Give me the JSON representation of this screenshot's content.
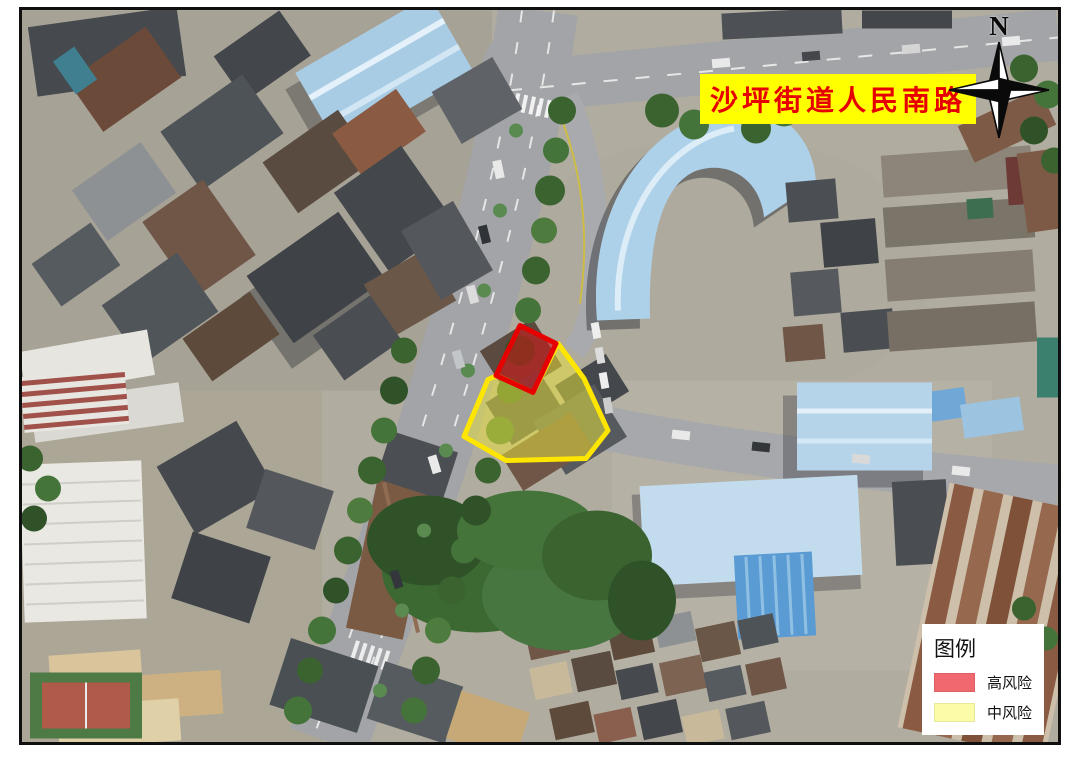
{
  "map": {
    "title": {
      "text": "沙坪街道人民南路",
      "color": "#e60000",
      "bg": "#ffff00"
    },
    "compass": {
      "label": "N"
    },
    "zones": [
      {
        "id": "medium-risk",
        "name": "中风险",
        "points": "536,333 562,368 586,420 564,448 484,450 442,426 466,369 475,365 511,382",
        "fill": "rgba(232,226,60,0.52)",
        "stroke": "#ffe600"
      },
      {
        "id": "high-risk",
        "name": "高风险",
        "points": "498,315 534,333 511,382 474,365",
        "fill": "rgba(214,24,24,0.58)",
        "stroke": "#e60000"
      }
    ]
  },
  "legend": {
    "title": "图例",
    "items": [
      {
        "label": "高风险",
        "color": "#f0696e"
      },
      {
        "label": "中风险",
        "color": "#fcfca8"
      }
    ]
  }
}
